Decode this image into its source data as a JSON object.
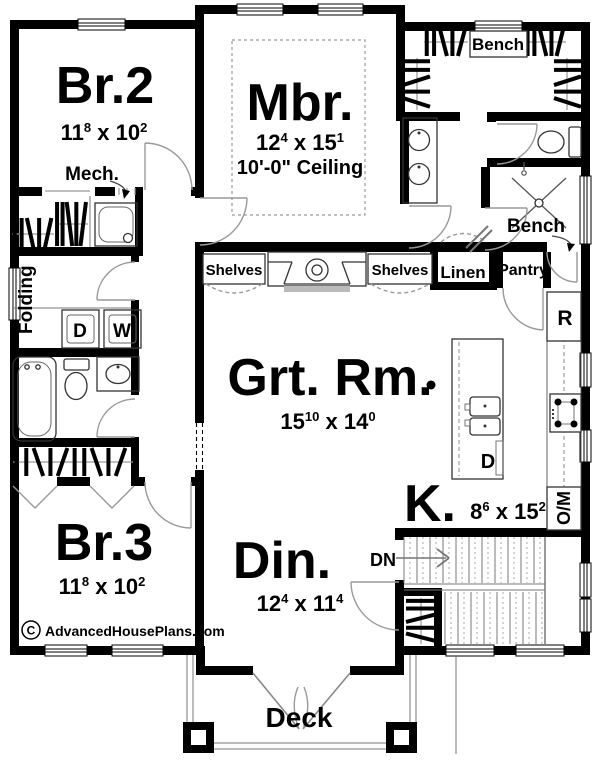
{
  "brand": {
    "copyright_symbol": "C",
    "watermark": "AdvancedHousePlans.com"
  },
  "rooms": {
    "br2": {
      "name": "Br.2",
      "dim": {
        "w": "11",
        "wsup": "8",
        "sep": " x ",
        "h": "10",
        "hsup": "2"
      }
    },
    "mbr": {
      "name": "Mbr.",
      "dim": {
        "w": "12",
        "wsup": "4",
        "sep": " x ",
        "h": "15",
        "hsup": "1"
      },
      "ceiling": "10'-0\" Ceiling"
    },
    "grt": {
      "name": "Grt. Rm.",
      "dim": {
        "w": "15",
        "wsup": "10",
        "sep": " x ",
        "h": "14",
        "hsup": "0"
      }
    },
    "br3": {
      "name": "Br.3",
      "dim": {
        "w": "11",
        "wsup": "8",
        "sep": " x ",
        "h": "10",
        "hsup": "2"
      }
    },
    "din": {
      "name": "Din.",
      "dim": {
        "w": "12",
        "wsup": "4",
        "sep": " x ",
        "h": "11",
        "hsup": "4"
      }
    },
    "kitchen": {
      "name": "K.",
      "dim": {
        "w": "8",
        "wsup": "6",
        "sep": " x ",
        "h": "15",
        "hsup": "2"
      }
    },
    "deck": {
      "name": "Deck"
    }
  },
  "labels": {
    "mech": "Mech.",
    "closet_bench": "Bench",
    "shower_bench": "Bench",
    "shelves_left": "Shelves",
    "shelves_right": "Shelves",
    "linen": "Linen",
    "pantry": "Pantry",
    "folding": "Folding",
    "stairs_dn": "DN",
    "dryer": "D",
    "washer": "W",
    "refrigerator": "R",
    "dishwasher": "D",
    "oven_microwave": "O/M"
  }
}
